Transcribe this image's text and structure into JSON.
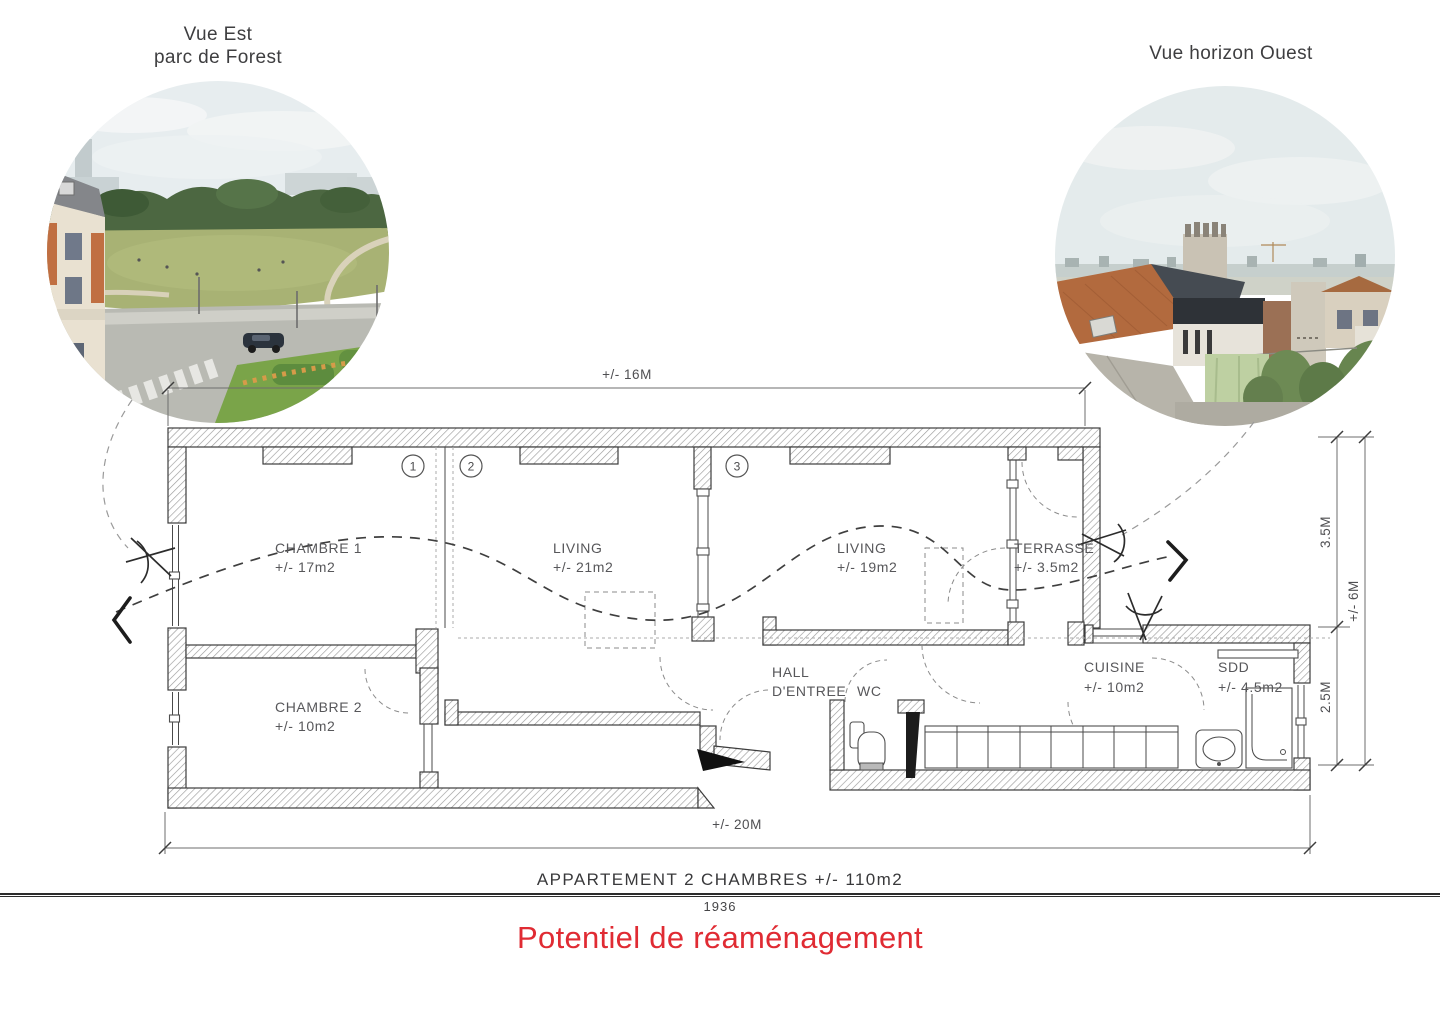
{
  "left_view": {
    "title_line1": "Vue Est",
    "title_line2": "parc de Forest"
  },
  "right_view": {
    "title": "Vue horizon Ouest"
  },
  "plan": {
    "rooms": {
      "chambre1": {
        "name": "CHAMBRE 1",
        "area": "+/- 17m2"
      },
      "living1": {
        "name": "LIVING",
        "area": "+/- 21m2"
      },
      "living2": {
        "name": "LIVING",
        "area": "+/- 19m2"
      },
      "terrasse": {
        "name": "TERRASSE",
        "area": "+/- 3.5m2"
      },
      "chambre2": {
        "name": "CHAMBRE 2",
        "area": "+/- 10m2"
      },
      "hall": {
        "name": "HALL",
        "name2": "D'ENTREE"
      },
      "wc": {
        "name": "WC"
      },
      "cuisine": {
        "name": "CUISINE",
        "area": "+/- 10m2"
      },
      "sdd": {
        "name": "SDD",
        "area": "+/- 4.5m2"
      }
    },
    "markers": [
      "1",
      "2",
      "3"
    ],
    "dimensions": {
      "top": "+/- 16M",
      "bottom": "+/- 20M",
      "right_upper": "3.5M",
      "right_lower": "2.5M",
      "right_total": "+/- 6M"
    }
  },
  "footer": {
    "title": "APPARTEMENT  2 CHAMBRES +/- 110m2",
    "year": "1936",
    "subtitle": "Potentiel de réaménagement"
  },
  "colors": {
    "accent_red": "#e02b33",
    "wall_line": "#3c3c3c",
    "label_gray": "#57575a"
  }
}
